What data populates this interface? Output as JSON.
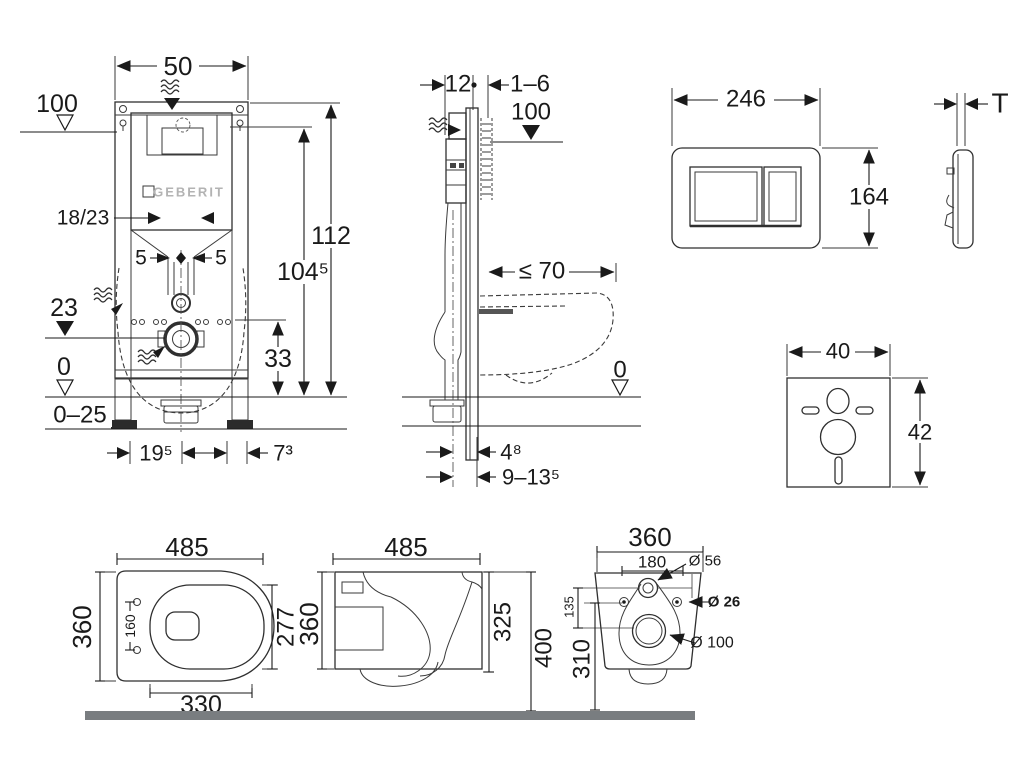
{
  "drawing": {
    "front_view": {
      "width": "50",
      "supply_level": "100",
      "brand": "GEBERIT",
      "bend": "18/23",
      "offset_left": "5",
      "offset_right": "5",
      "outlet_level": "23",
      "zero_level": "0",
      "floor_range": "0–25",
      "total_height": "112",
      "plate_height": "104⁵",
      "outlet_axis": "33",
      "foot_left": "19⁵",
      "foot_right": "7³"
    },
    "side_view": {
      "frame_depth": "12",
      "wall_gap": "1–6",
      "supply_level": "100",
      "bowl_depth": "≤ 70",
      "zero_level": "0",
      "outlet_offset": "4⁸",
      "outlet_range": "9–13⁵"
    },
    "flush_plate": {
      "width": "246",
      "height": "164",
      "thickness": "T"
    },
    "sound_pad": {
      "width": "40",
      "height": "42"
    },
    "bowl_top": {
      "length": "485",
      "width": "360",
      "hinge_spacing": "160",
      "inner_length": "277",
      "fixing_length": "330"
    },
    "bowl_side": {
      "length": "485",
      "height": "360",
      "rim_height": "325",
      "install_height": "400"
    },
    "bowl_back": {
      "width": "360",
      "hole_spacing": "180",
      "inlet_dia": "Ø 56",
      "hole_dia": "Ø 26",
      "outlet_dia": "Ø 100",
      "inlet_axis": "135",
      "outlet_axis": "310"
    }
  }
}
